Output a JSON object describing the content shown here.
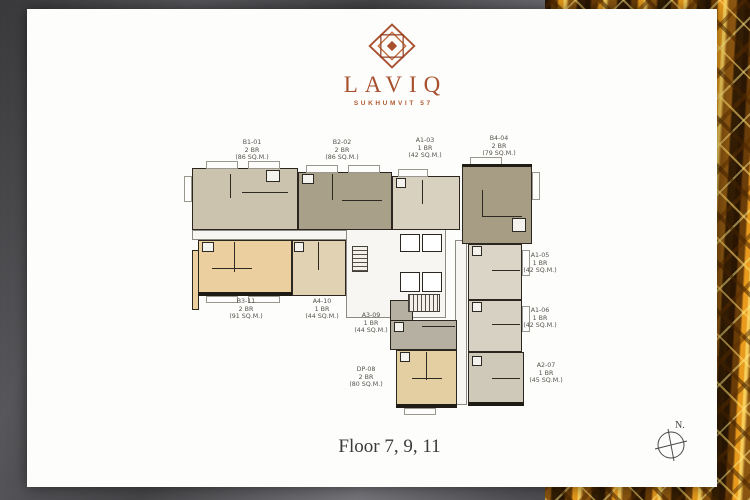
{
  "brand": {
    "name": "LAVIQ",
    "subtitle": "SUKHUMVIT 57"
  },
  "floor_label": "Floor 7, 9, 11",
  "compass": {
    "label": "N."
  },
  "units": [
    {
      "id": "B1-01",
      "type": "2 BR",
      "area": "(86 SQ.M.)"
    },
    {
      "id": "B2-02",
      "type": "2 BR",
      "area": "(86 SQ.M.)"
    },
    {
      "id": "A1-03",
      "type": "1 BR",
      "area": "(42 SQ.M.)"
    },
    {
      "id": "B4-04",
      "type": "2 BR",
      "area": "(79 SQ.M.)"
    },
    {
      "id": "A1-05",
      "type": "1 BR",
      "area": "(42 SQ.M.)"
    },
    {
      "id": "A1-06",
      "type": "1 BR",
      "area": "(42 SQ.M.)"
    },
    {
      "id": "A2-07",
      "type": "1 BR",
      "area": "(45 SQ.M.)"
    },
    {
      "id": "DP-08",
      "type": "2 BR",
      "area": "(80 SQ.M.)"
    },
    {
      "id": "A3-09",
      "type": "1 BR",
      "area": "(44 SQ.M.)"
    },
    {
      "id": "A4-10",
      "type": "1 BR",
      "area": "(44 SQ.M.)"
    },
    {
      "id": "B3-11",
      "type": "2 BR",
      "area": "(91 SQ.M.)"
    }
  ],
  "palette": {
    "logo_copper": "#a8502e",
    "wall_dark": "#2b2620",
    "unit_beige": "#cbc3ad",
    "unit_olive": "#a9a089",
    "unit_taupe": "#a79d84",
    "unit_peach": "#eccf9f",
    "unit_tan": "#e4cfa2",
    "unit_gray": "#b5b0a2",
    "unit_lightgray": "#dad5c7",
    "gold_accent": "#e89b1c",
    "backdrop_gray": "#57575b"
  }
}
